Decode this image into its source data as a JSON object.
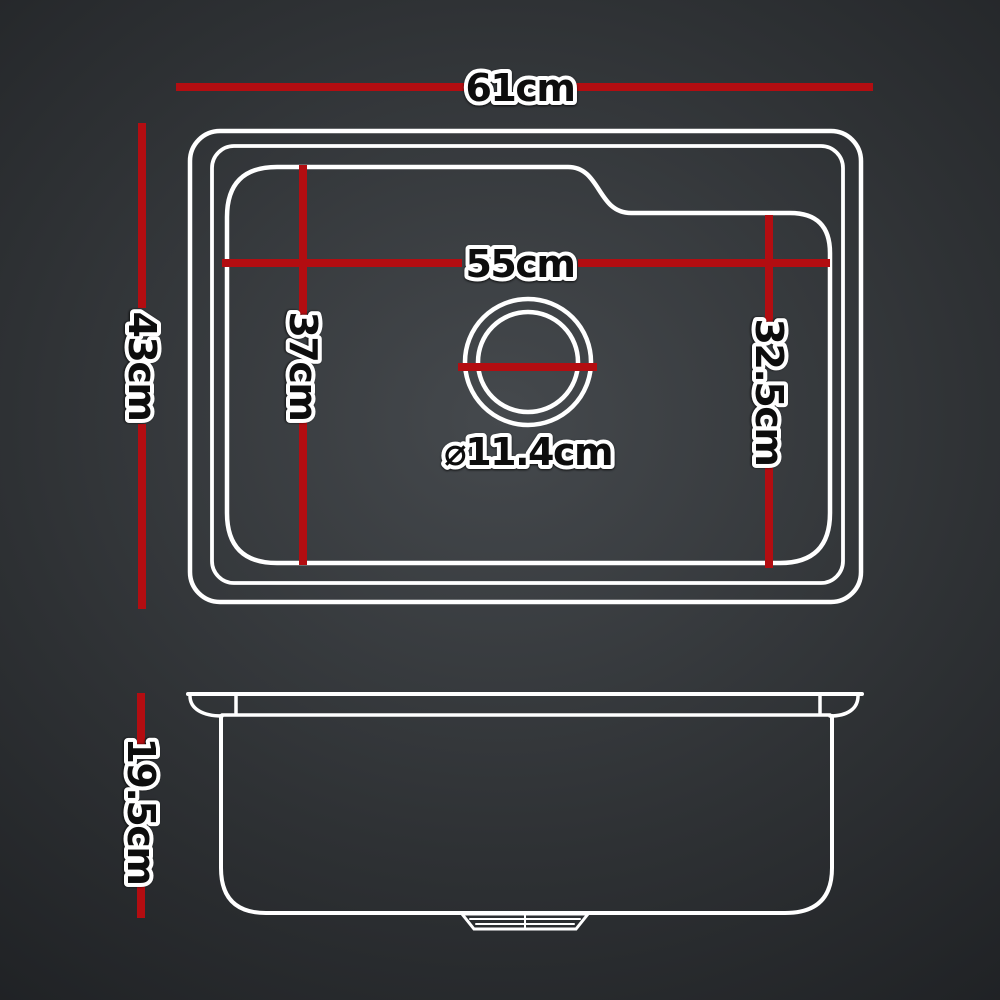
{
  "labels": {
    "top_width": "61cm",
    "top_depth": "43cm",
    "bowl_width": "55cm",
    "bowl_depth_left": "37cm",
    "bowl_depth_right": "32.5cm",
    "drain_diameter": "⌀11.4cm",
    "side_height": "19.5cm"
  },
  "colors": {
    "dimension-red": "#b30d11",
    "line-white": "#ffffff",
    "label-fill": "#0d0d0d",
    "label-outline": "#ffffff",
    "bg-center": "#45494d",
    "bg-mid": "#2e3134",
    "bg-edge": "#0a0b0d"
  }
}
